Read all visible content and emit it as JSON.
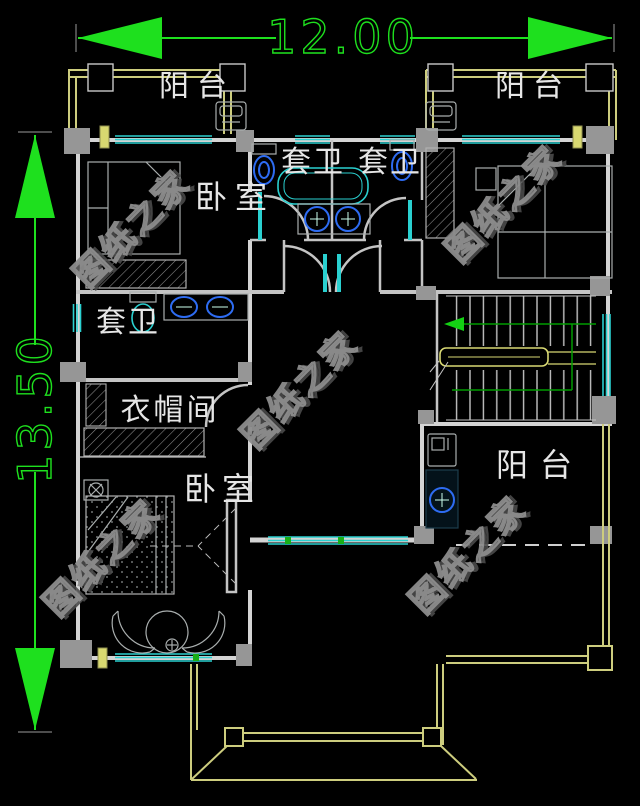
{
  "drawing": {
    "dimension_top": "12.00",
    "dimension_left": "13.50",
    "rooms": {
      "balcony_top_left": "阳台",
      "balcony_top_right": "阳台",
      "bedroom_top": "卧室",
      "ensuite_center_left": "套卫",
      "ensuite_center_right": "套卫",
      "ensuite_left": "套卫",
      "cloakroom": "衣帽间",
      "bedroom_bottom": "卧室",
      "balcony_bottom_right": "阳台"
    },
    "watermark": "图纸之家",
    "colors": {
      "background": "#000000",
      "dimension_green": "#1ee01e",
      "wall_white": "#d4d4d4",
      "balcony_yellow": "#cdcd7e",
      "window_cyan": "#2ad0d0",
      "fixture_blue": "#2e6cf2",
      "stair_green": "#009c00",
      "column_gray": "#969696",
      "watermark_gray": "#8d8d8d"
    }
  }
}
